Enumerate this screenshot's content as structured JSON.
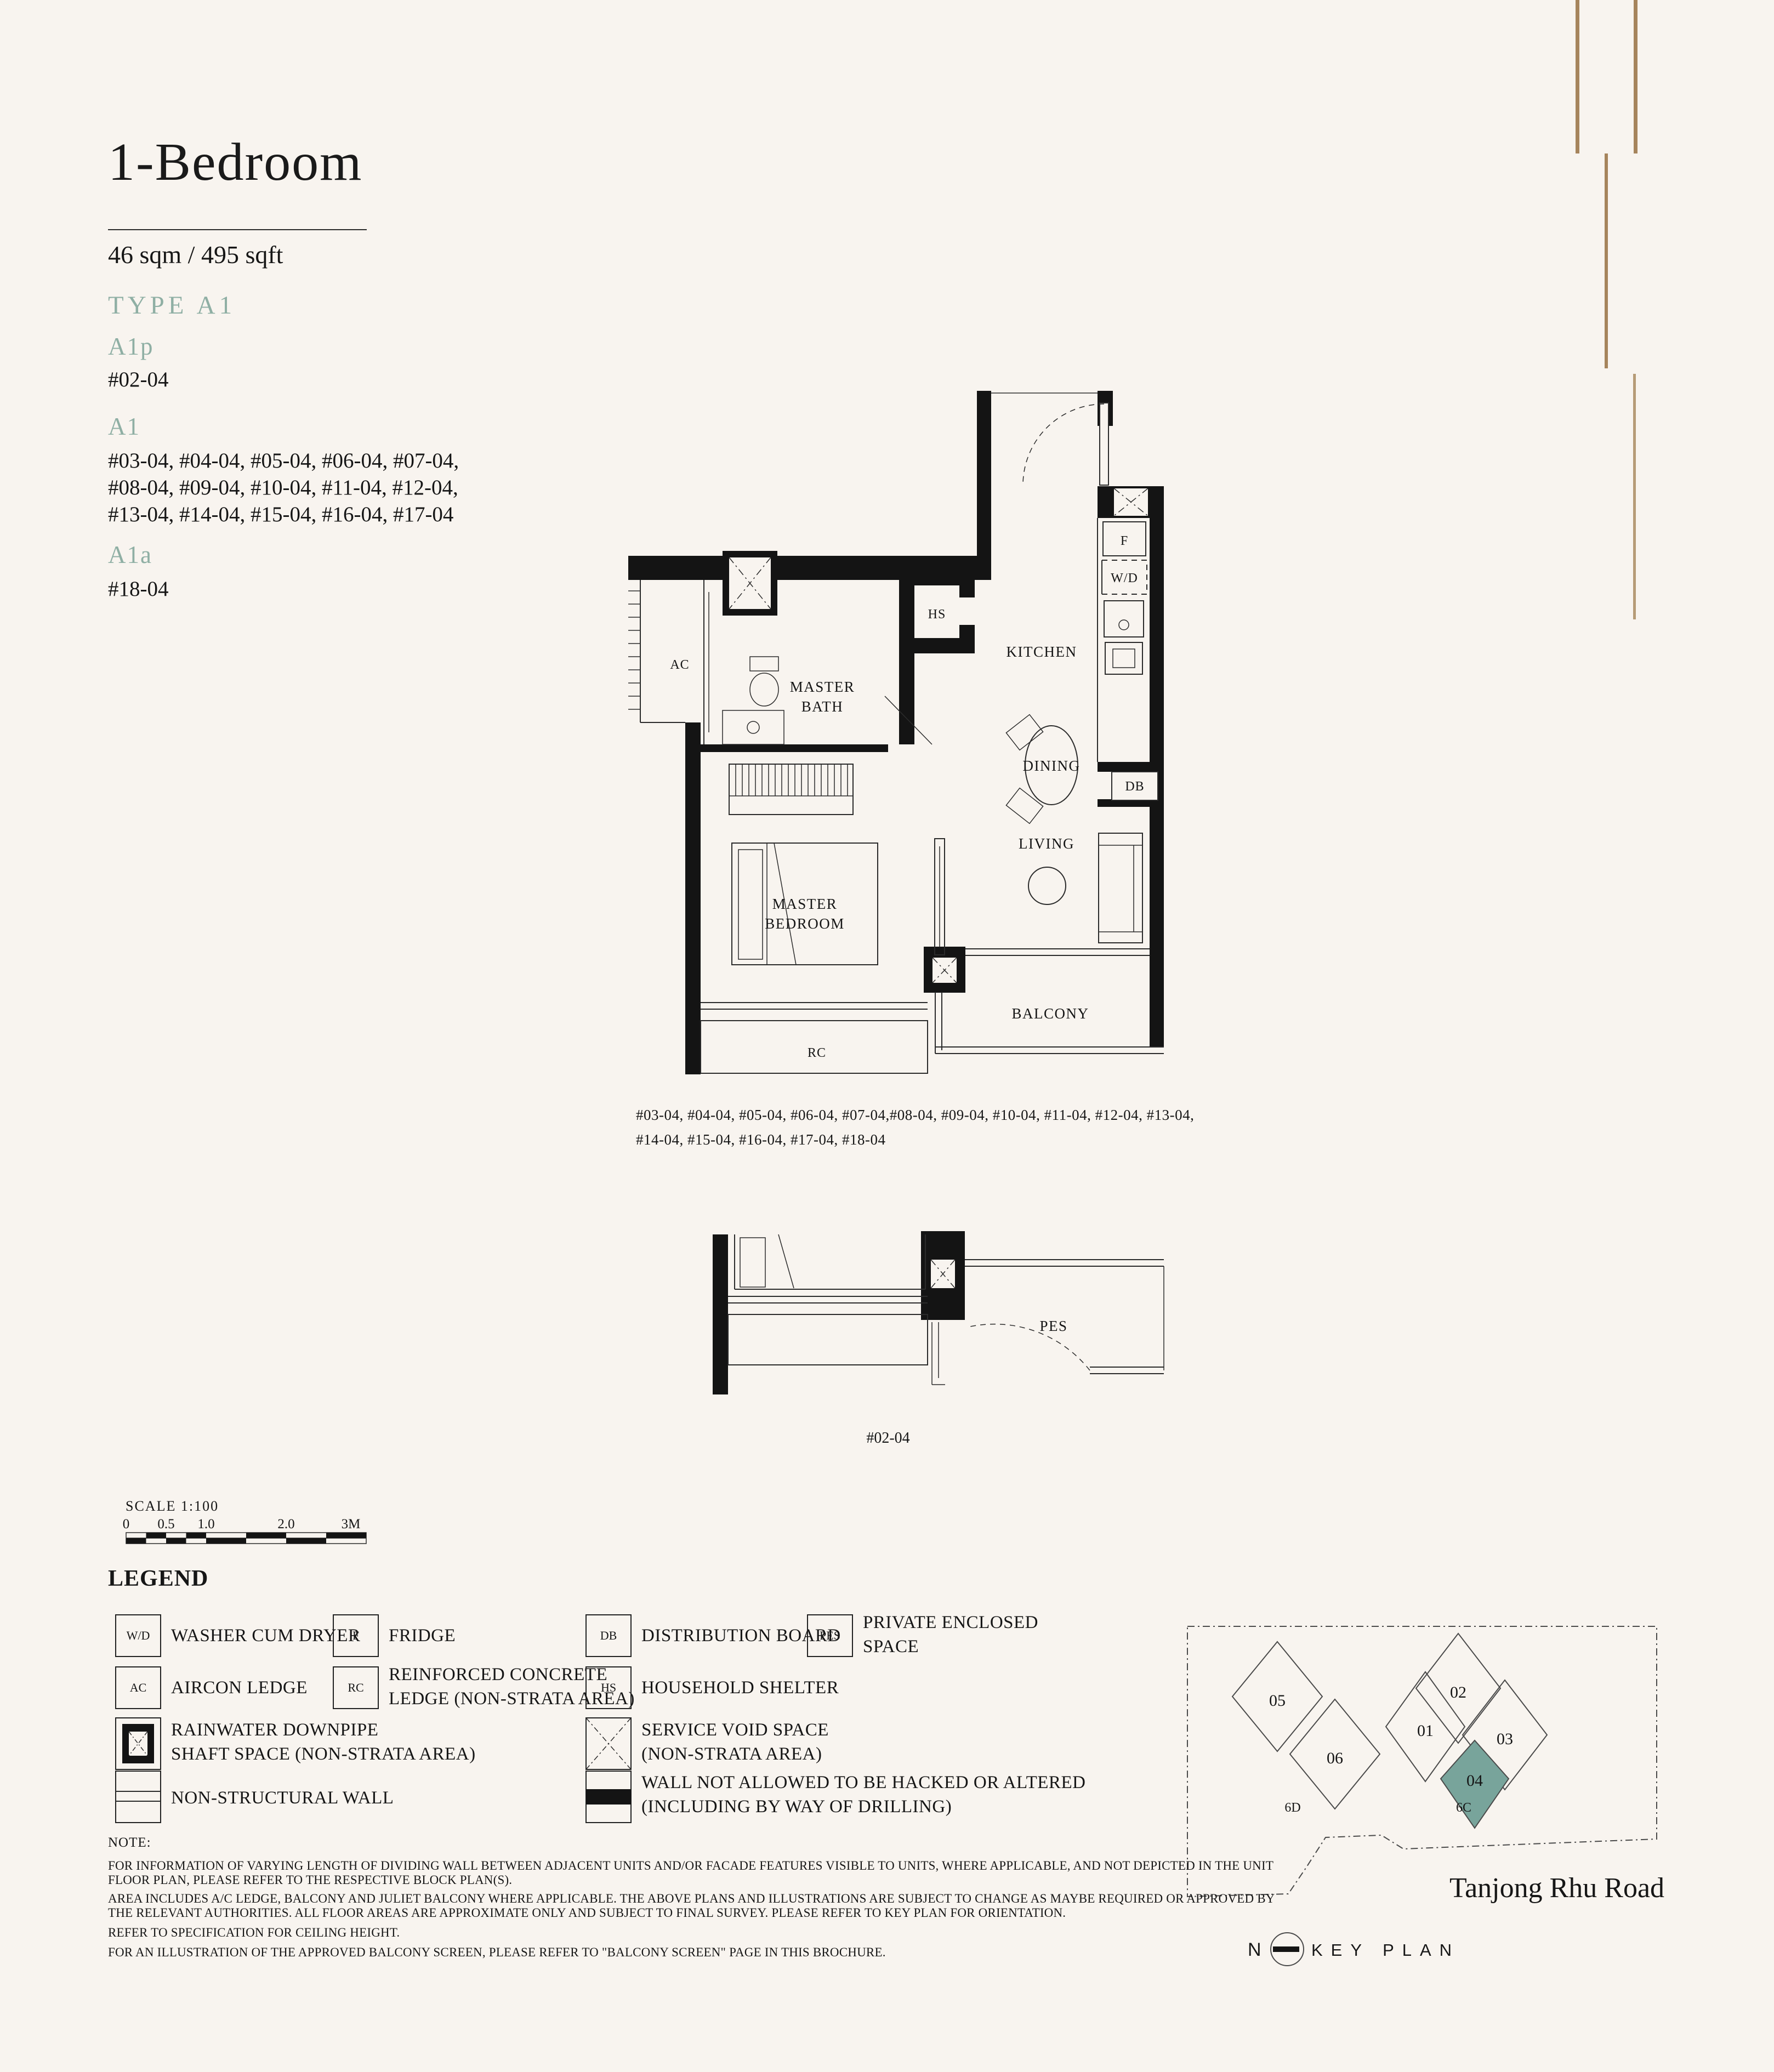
{
  "page": {
    "background": "#F8F4EF",
    "accent": "#8FAFA4",
    "gold": "#A6845C",
    "highlight_teal": "#78A49B"
  },
  "header": {
    "title": "1-Bedroom",
    "area": "46 sqm / 495 sqft",
    "type_label": "TYPE A1",
    "variants": [
      {
        "code": "A1p",
        "lines": [
          "#02-04"
        ]
      },
      {
        "code": "A1",
        "lines": [
          "#03-04, #04-04, #05-04, #06-04, #07-04,",
          "#08-04, #09-04, #10-04, #11-04, #12-04,",
          "#13-04, #14-04, #15-04, #16-04, #17-04"
        ]
      },
      {
        "code": "A1a",
        "lines": [
          "#18-04"
        ]
      }
    ]
  },
  "floorplan": {
    "labels": {
      "ac": "AC",
      "hs": "HS",
      "kitchen": "KITCHEN",
      "master_bath_1": "MASTER",
      "master_bath_2": "BATH",
      "fridge": "F",
      "washer_dryer": "W/D",
      "dining": "DINING",
      "db": "DB",
      "living": "LIVING",
      "master_bedroom_1": "MASTER",
      "master_bedroom_2": "BEDROOM",
      "rc": "RC",
      "balcony": "BALCONY"
    },
    "caption_lines": [
      "#03-04, #04-04, #05-04, #06-04, #07-04,#08-04, #09-04, #10-04, #11-04, #12-04, #13-04,",
      "#14-04, #15-04, #16-04, #17-04, #18-04"
    ]
  },
  "lower_plan": {
    "label_pes": "PES",
    "caption": "#02-04"
  },
  "scale_bar": {
    "label": "SCALE  1:100",
    "ticks": [
      "0",
      "0.5",
      "1.0",
      "2.0",
      "3M"
    ]
  },
  "legend": {
    "heading": "LEGEND",
    "items": [
      {
        "symbol": "W/D",
        "lines": [
          "WASHER CUM DRYER"
        ]
      },
      {
        "symbol": "F",
        "lines": [
          "FRIDGE"
        ]
      },
      {
        "symbol": "DB",
        "lines": [
          "DISTRIBUTION BOARD"
        ]
      },
      {
        "symbol": "PES",
        "lines": [
          "PRIVATE ENCLOSED",
          "SPACE"
        ]
      },
      {
        "symbol": "AC",
        "lines": [
          "AIRCON LEDGE"
        ]
      },
      {
        "symbol": "RC",
        "lines": [
          "REINFORCED CONCRETE",
          "LEDGE (NON-STRATA AREA)"
        ]
      },
      {
        "symbol": "HS",
        "lines": [
          "HOUSEHOLD SHELTER"
        ]
      },
      {
        "symbol": "rainwater-downpipe",
        "lines": [
          "RAINWATER DOWNPIPE",
          "SHAFT SPACE (NON-STRATA AREA)"
        ]
      },
      {
        "symbol": "service-void",
        "lines": [
          "SERVICE VOID SPACE",
          "(NON-STRATA AREA)"
        ]
      },
      {
        "symbol": "non-structural-wall",
        "lines": [
          "NON-STRUCTURAL WALL"
        ]
      },
      {
        "symbol": "no-hack-wall",
        "lines": [
          "WALL NOT ALLOWED TO BE HACKED OR ALTERED",
          "(INCLUDING BY WAY OF DRILLING)"
        ]
      }
    ]
  },
  "notes": {
    "heading": "NOTE:",
    "paragraphs": [
      {
        "lines": [
          "FOR INFORMATION OF VARYING LENGTH OF DIVIDING WALL BETWEEN ADJACENT UNITS AND/OR FACADE FEATURES VISIBLE TO UNITS, WHERE APPLICABLE, AND NOT DEPICTED IN THE UNIT",
          "FLOOR PLAN, PLEASE REFER TO THE RESPECTIVE BLOCK PLAN(S)."
        ]
      },
      {
        "lines": [
          "AREA INCLUDES A/C LEDGE, BALCONY AND JULIET BALCONY WHERE APPLICABLE. THE ABOVE PLANS AND ILLUSTRATIONS ARE SUBJECT TO CHANGE AS MAYBE REQUIRED OR APPROVED BY",
          "THE RELEVANT AUTHORITIES. ALL FLOOR AREAS ARE APPROXIMATE ONLY AND SUBJECT TO FINAL SURVEY. PLEASE REFER TO KEY PLAN FOR ORIENTATION."
        ]
      },
      {
        "lines": [
          "REFER TO SPECIFICATION FOR CEILING HEIGHT."
        ]
      },
      {
        "lines": [
          "FOR AN ILLUSTRATION OF THE APPROVED BALCONY SCREEN, PLEASE REFER TO \"BALCONY SCREEN\" PAGE IN THIS BROCHURE."
        ]
      }
    ]
  },
  "key_plan": {
    "road": "Tanjong Rhu Road",
    "north": "N",
    "label": "KEY PLAN",
    "block_left": "6D",
    "block_right": "6C",
    "units": {
      "u05": "05",
      "u06": "06",
      "u02": "02",
      "u01": "01",
      "u03": "03",
      "u04": "04"
    },
    "highlighted": "04"
  }
}
